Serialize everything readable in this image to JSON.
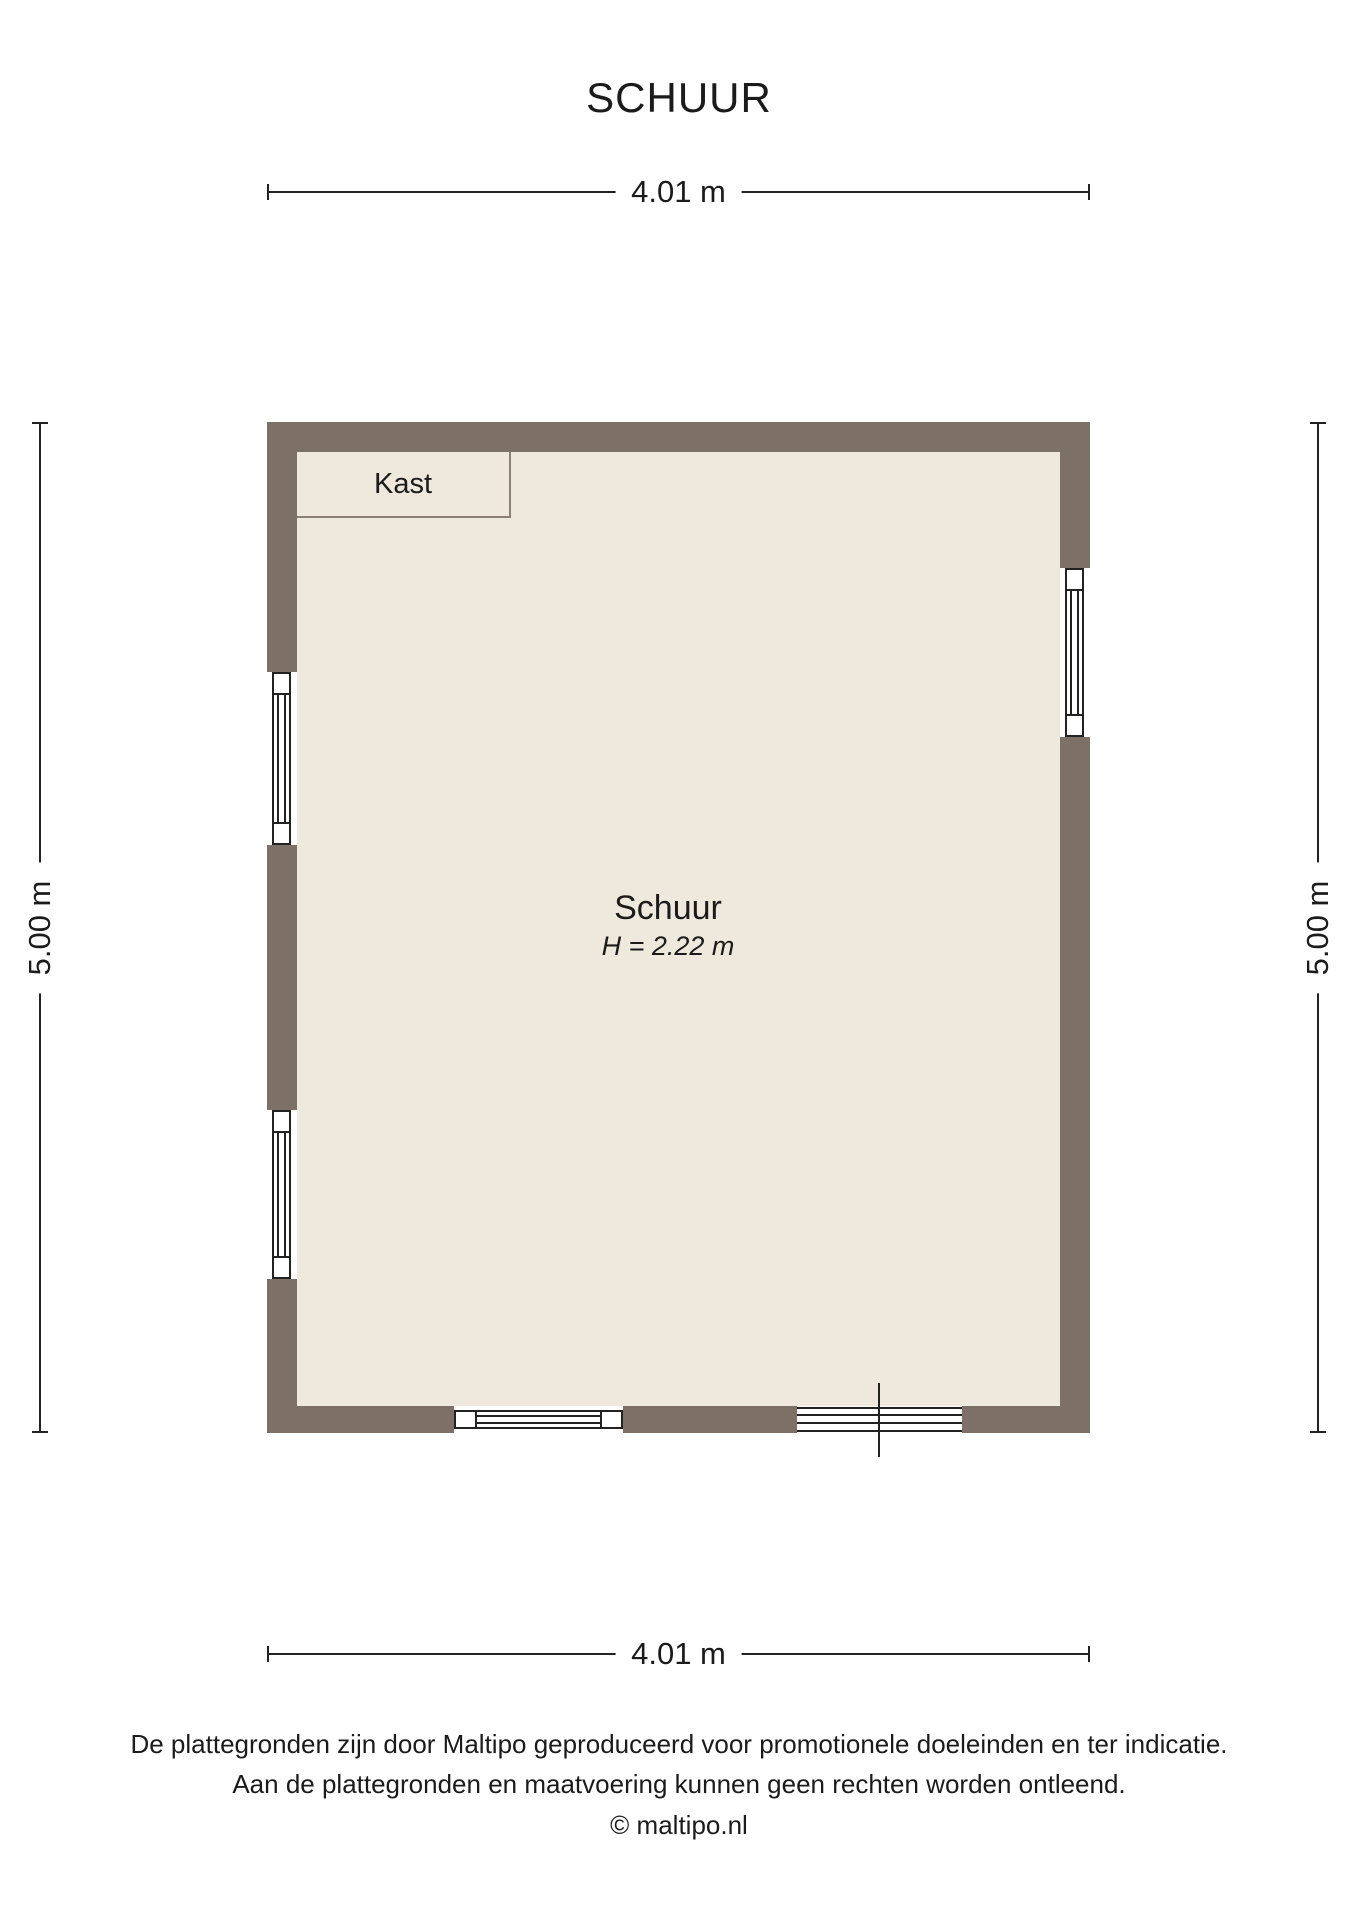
{
  "title": "SCHUUR",
  "dimensions": {
    "top": "4.01 m",
    "bottom": "4.01 m",
    "left": "5.00 m",
    "right": "5.00 m"
  },
  "room": {
    "name": "Schuur",
    "height_label": "H = 2.22 m"
  },
  "closet": {
    "label": "Kast"
  },
  "footer": {
    "line1": "De plattegronden zijn door Maltipo geproduceerd voor promotionele doeleinden en ter indicatie.",
    "line2": "Aan de plattegronden en maatvoering kunnen geen rechten worden ontleend.",
    "line3": "© maltipo.nl"
  },
  "colors": {
    "wall": "#7d7167",
    "floor": "#efe8dd",
    "line": "#222222",
    "text": "#1b1b1b"
  }
}
